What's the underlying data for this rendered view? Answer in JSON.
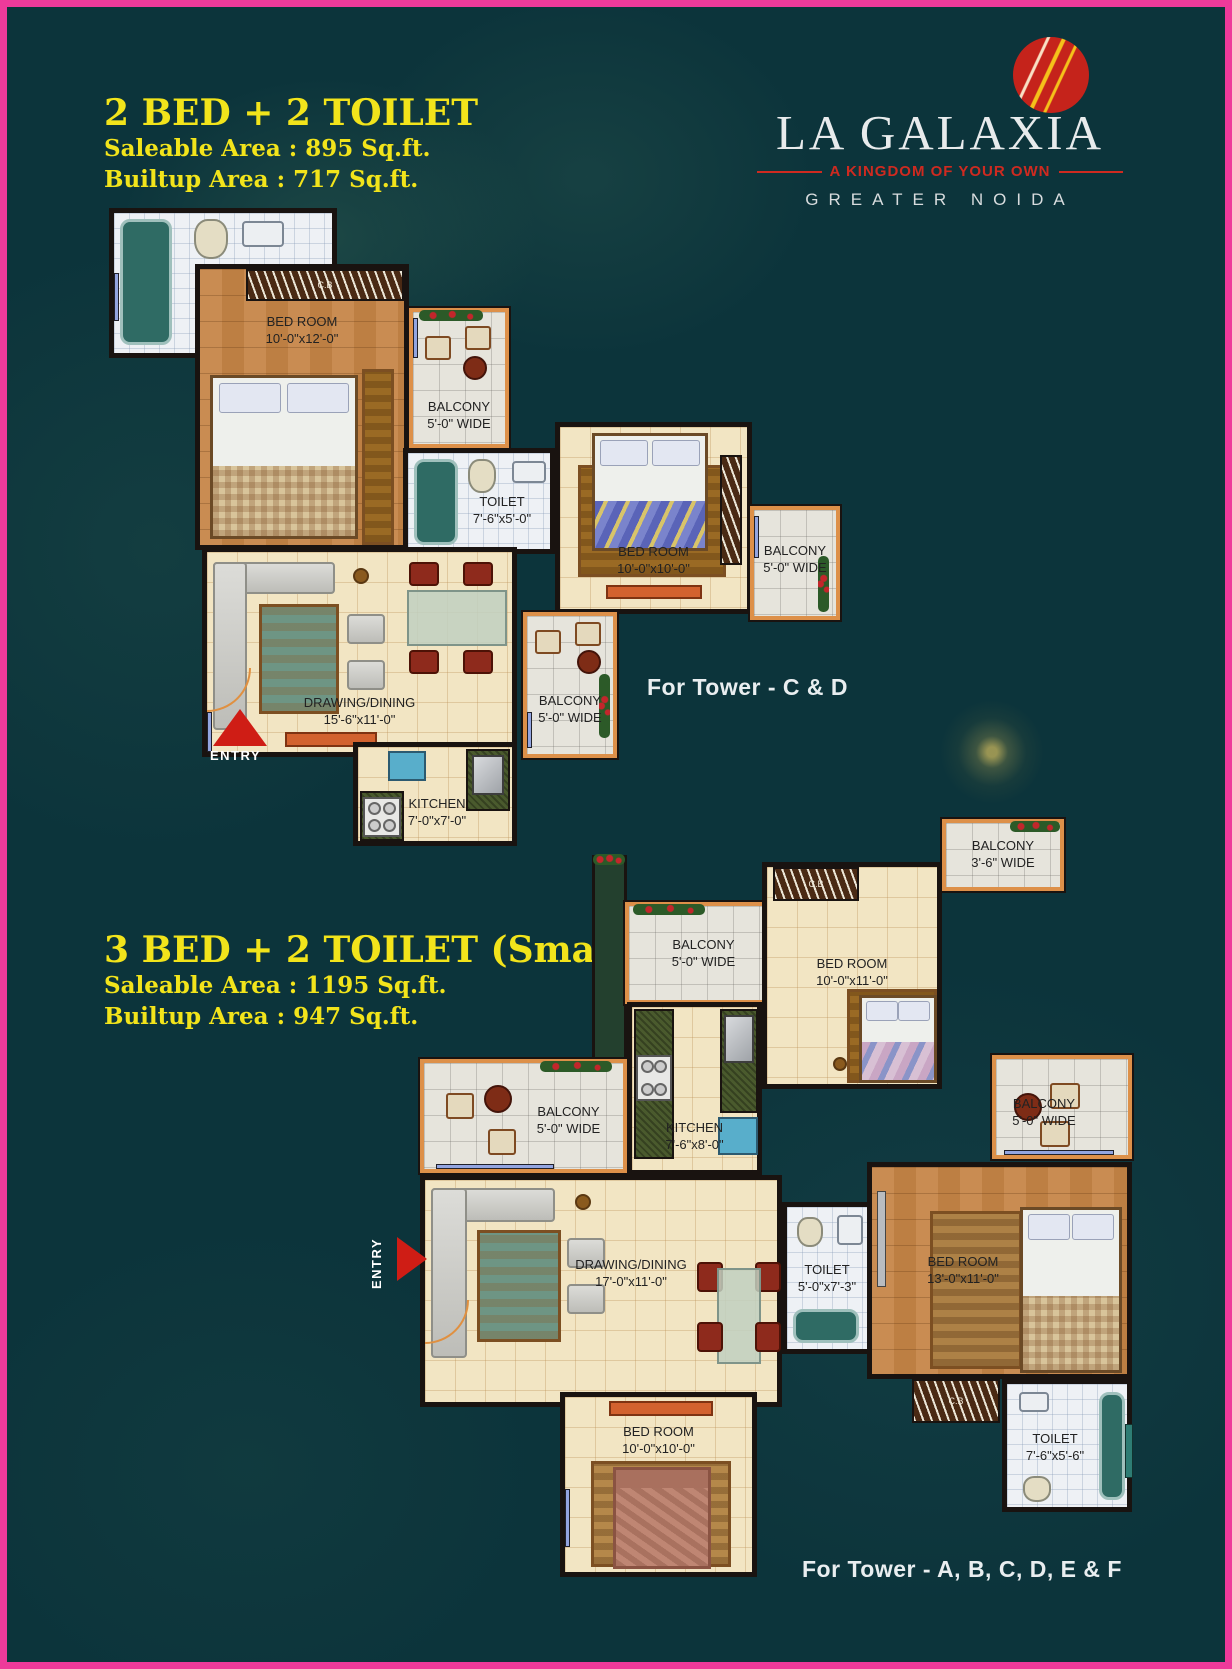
{
  "page": {
    "border_color": "#ee3a9a",
    "background_color": "#0c343b"
  },
  "brand": {
    "name": "LA GALAXIA",
    "tagline": "A KINGDOM OF YOUR OWN",
    "location": "GREATER NOIDA",
    "logo_circle_color": "#c5231b"
  },
  "labels": {
    "cb": "C.B",
    "entry": "ENTRY"
  },
  "plan1": {
    "title": "2 BED + 2 TOILET",
    "saleable_area": "Saleable Area : 895 Sq.ft.",
    "builtup_area": "Builtup Area : 717 Sq.ft.",
    "tower": "For Tower - C & D",
    "rooms": {
      "toilet_top": {
        "name": "TOILET",
        "dims": "7'-6\"x5'-0\""
      },
      "bedroom_main": {
        "name": "BED ROOM",
        "dims": "10'-0\"x12'-0\""
      },
      "balcony_mid": {
        "name": "BALCONY",
        "dims": "5'-0\" WIDE"
      },
      "toilet_mid": {
        "name": "TOILET",
        "dims": "7'-6\"x5'-0\""
      },
      "bedroom_second": {
        "name": "BED ROOM",
        "dims": "10'-0\"x10'-0\""
      },
      "balcony_right": {
        "name": "BALCONY",
        "dims": "5'-0\" WIDE"
      },
      "drawing_dining": {
        "name": "DRAWING/DINING",
        "dims": "15'-6\"x11'-0\""
      },
      "balcony_bottom": {
        "name": "BALCONY",
        "dims": "5'-0\" WIDE"
      },
      "kitchen": {
        "name": "KITCHEN",
        "dims": "7'-0\"x7'-0\""
      }
    }
  },
  "plan2": {
    "title": "3 BED + 2 TOILET (Small)",
    "saleable_area": "Saleable Area : 1195 Sq.ft.",
    "builtup_area": "Builtup Area : 947 Sq.ft.",
    "tower": "For Tower - A, B, C, D, E & F",
    "rooms": {
      "balcony_top": {
        "name": "BALCONY",
        "dims": "5'-0\" WIDE"
      },
      "bedroom_top": {
        "name": "BED ROOM",
        "dims": "10'-0\"x11'-0\""
      },
      "balcony_small": {
        "name": "BALCONY",
        "dims": "3'-6\" WIDE"
      },
      "balcony_left": {
        "name": "BALCONY",
        "dims": "5'-0\" WIDE"
      },
      "kitchen": {
        "name": "KITCHEN",
        "dims": "7'-6\"x8'-0\""
      },
      "balcony_right": {
        "name": "BALCONY",
        "dims": "5'-0\" WIDE"
      },
      "bedroom_right": {
        "name": "BED ROOM",
        "dims": "13'-0\"x11'-0\""
      },
      "toilet_mid": {
        "name": "TOILET",
        "dims": "5'-0\"x7'-3\""
      },
      "drawing_dining": {
        "name": "DRAWING/DINING",
        "dims": "17'-0\"x11'-0\""
      },
      "bedroom_bottom": {
        "name": "BED ROOM",
        "dims": "10'-0\"x10'-0\""
      },
      "toilet_bottom": {
        "name": "TOILET",
        "dims": "7'-6\"x5'-6\""
      }
    }
  }
}
